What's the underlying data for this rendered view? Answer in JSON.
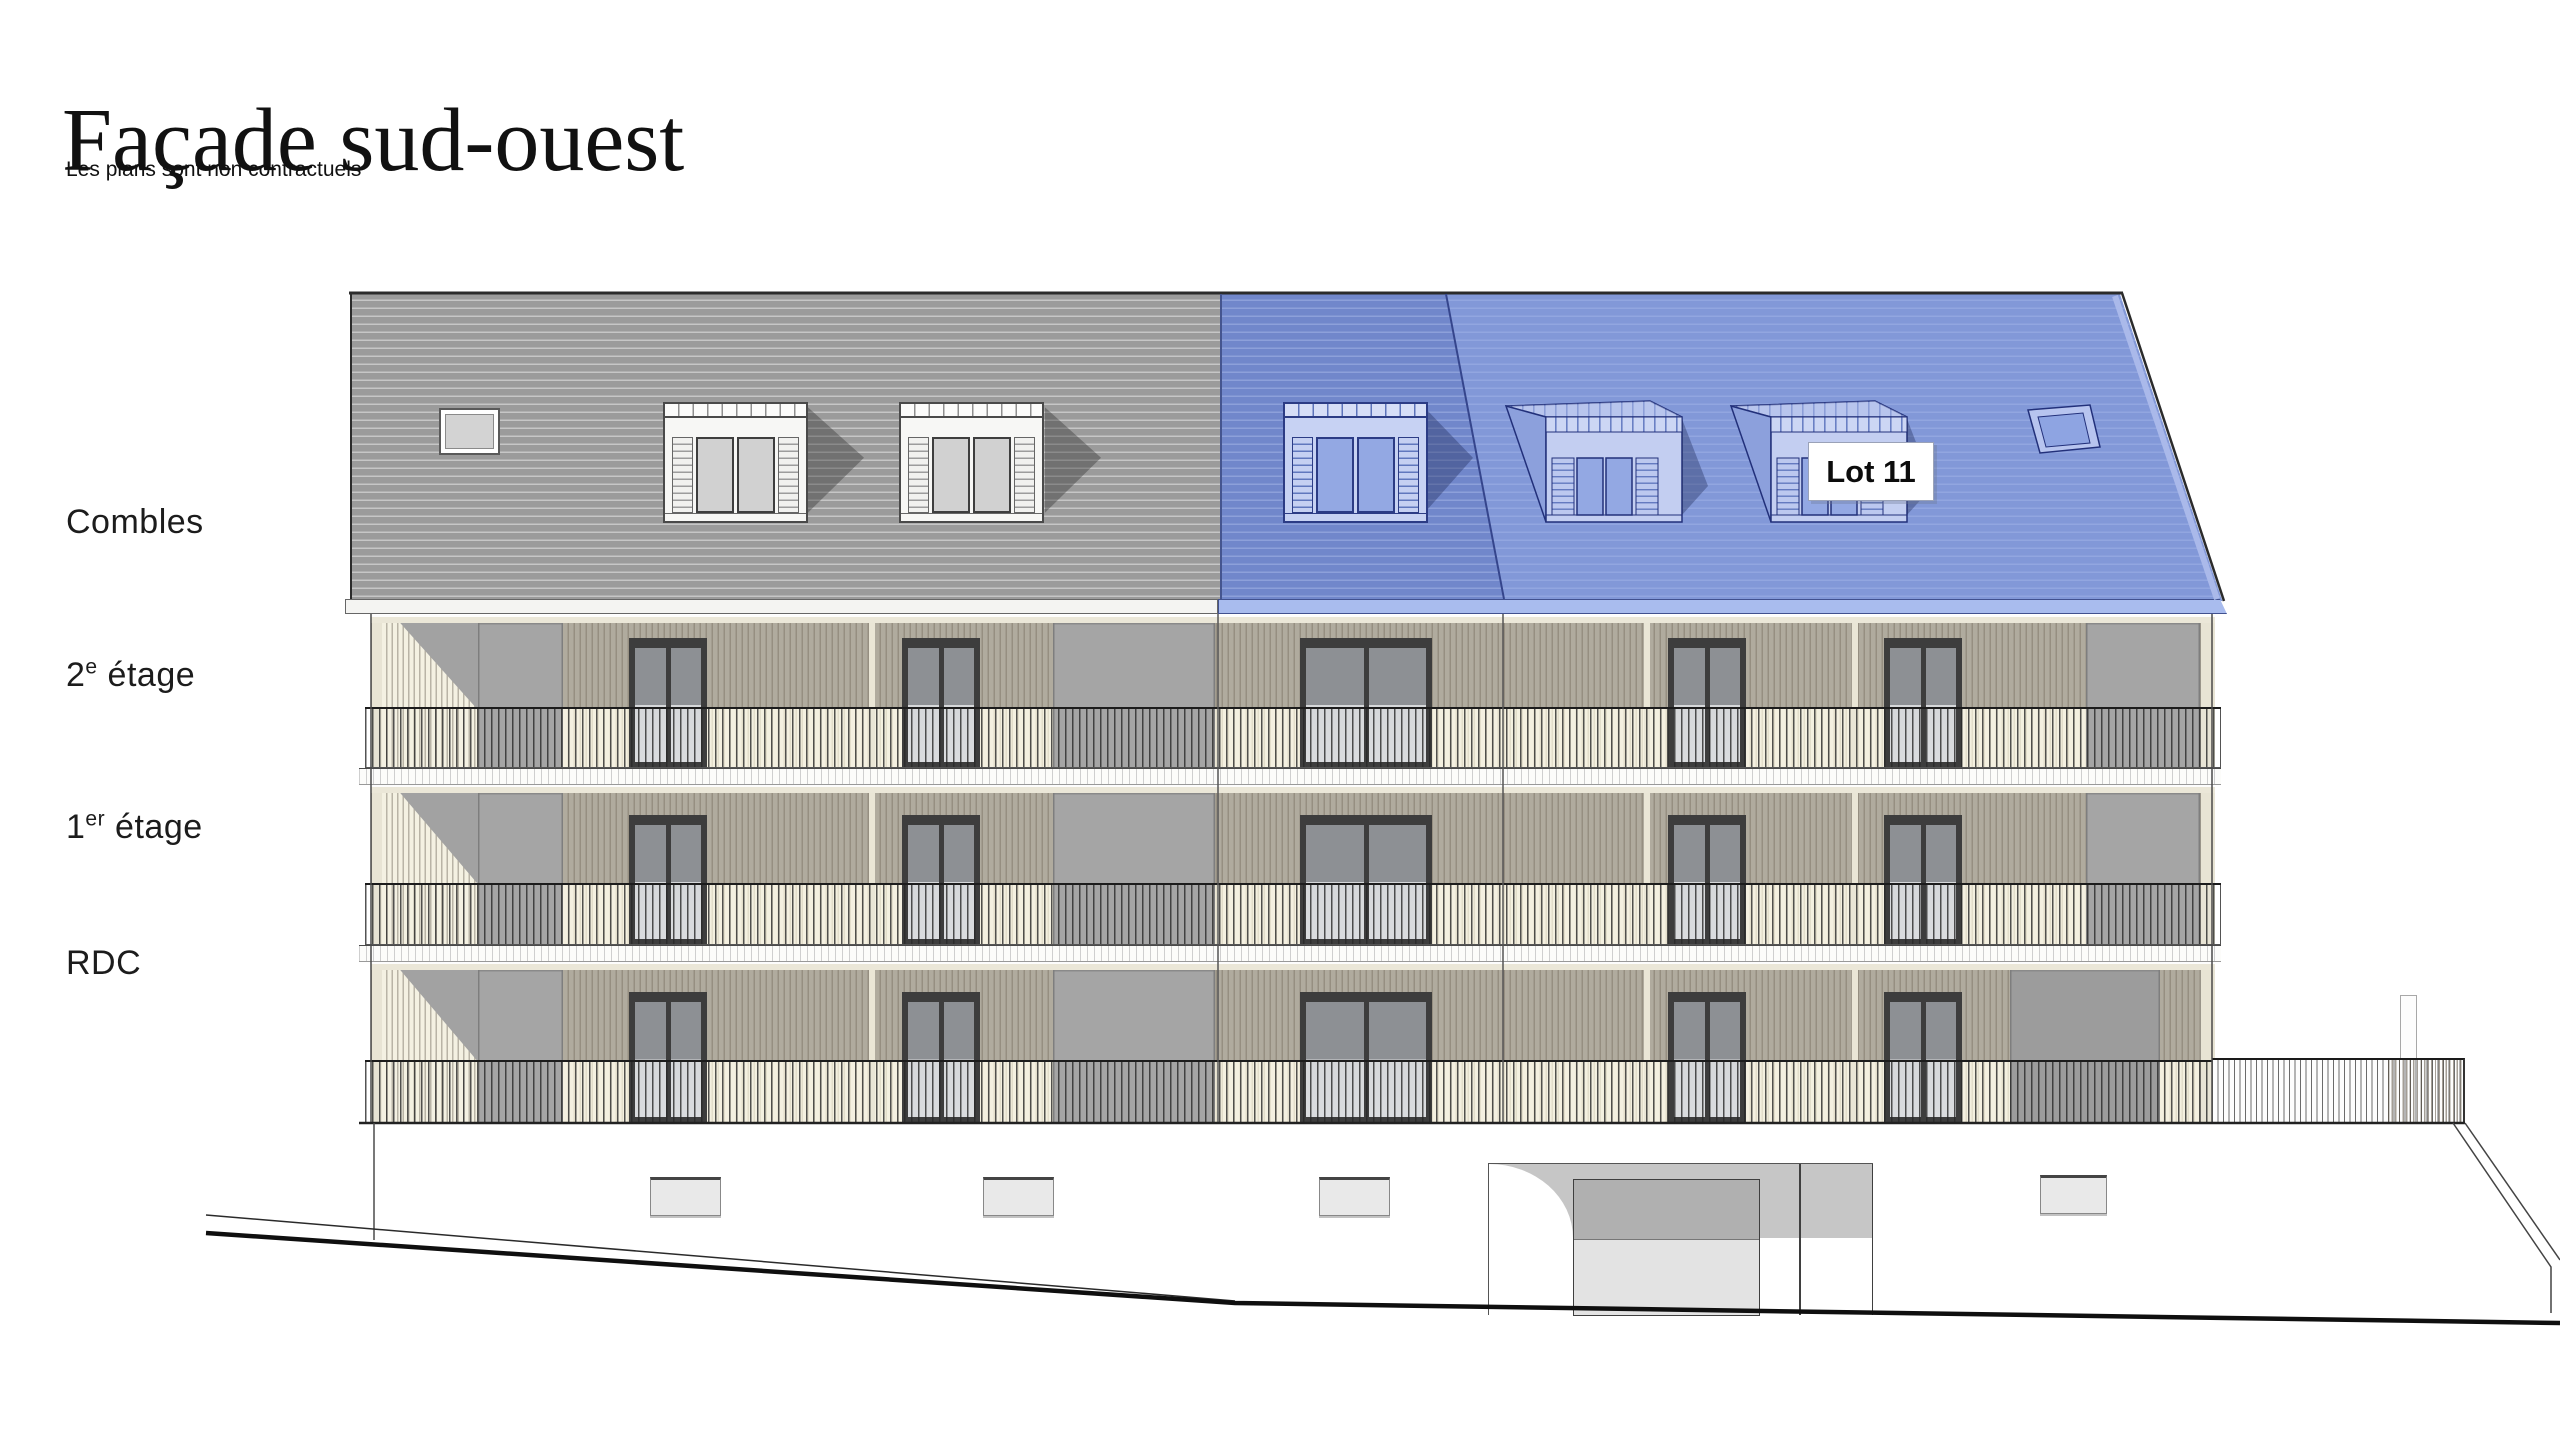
{
  "header": {
    "title": "Façade sud-ouest",
    "subtitle": "Les plans sont non contractuels"
  },
  "floor_labels": [
    {
      "main": "Combles",
      "sup": "",
      "rest": ""
    },
    {
      "main": "2",
      "sup": "e",
      "rest": " étage"
    },
    {
      "main": "1",
      "sup": "er",
      "rest": " étage"
    },
    {
      "main": "RDC",
      "sup": "",
      "rest": ""
    }
  ],
  "lot_badge": {
    "label": "Lot 11"
  },
  "legend_colors": {
    "highlight_roof": "#7187cb",
    "highlight_roof_light": "#8298d8",
    "roof_gray": "#9b9b9b",
    "facade_cladding": "#b0ab9e",
    "facade_cream": "#f4f0e0",
    "panel_gray": "#a5a5a5",
    "fascia_blue": "#a9bcee"
  }
}
